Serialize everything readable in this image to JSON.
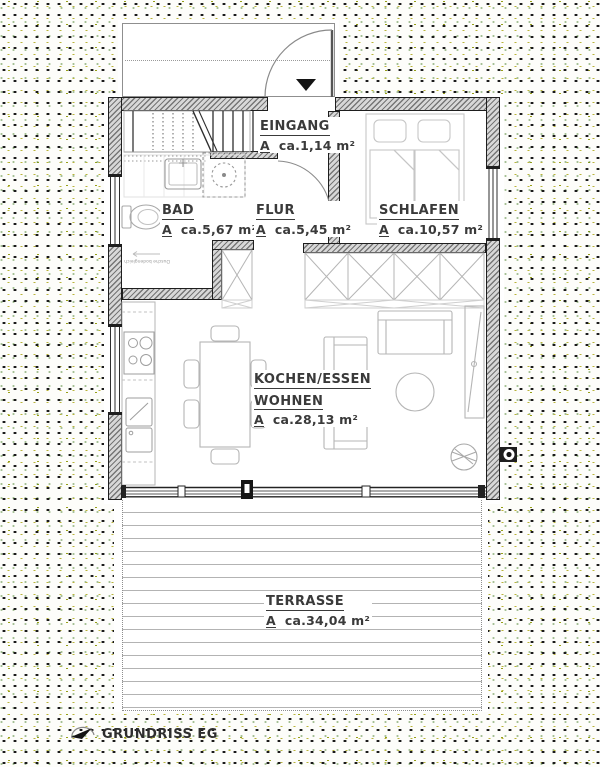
{
  "title": {
    "plan_label": "GRUNDRISS EG"
  },
  "rooms": {
    "eingang": {
      "name": "EINGANG",
      "a": "A",
      "area": "ca.1,14 m²"
    },
    "bad": {
      "name": "BAD",
      "a": "A",
      "area": "ca.5,67 m²"
    },
    "flur": {
      "name": "FLUR",
      "a": "A",
      "area": "ca.5,45 m²"
    },
    "schlafen": {
      "name": "SCHLAFEN",
      "a": "A",
      "area": "ca.10,57 m²"
    },
    "wohnen": {
      "name1": "KOCHEN/ESSEN",
      "name2": "WOHNEN",
      "a": "A",
      "area": "ca.28,13 m²"
    },
    "terrasse": {
      "name": "TERRASSE",
      "a": "A",
      "area": "ca.34,04 m²"
    }
  },
  "annotations": {
    "shower_note": "Dusche bodengleich"
  },
  "icons": {
    "north_arrow": "north-arrow-icon",
    "entrance_marker": "entrance-arrow-icon"
  },
  "colors": {
    "wall_hatch": "#767676",
    "outline": "#1e1e1e",
    "furniture": "#b5b5b5",
    "dot_black": "#1a1a1a",
    "dot_olive": "#b9b43a",
    "dot_green": "#4d8430"
  }
}
